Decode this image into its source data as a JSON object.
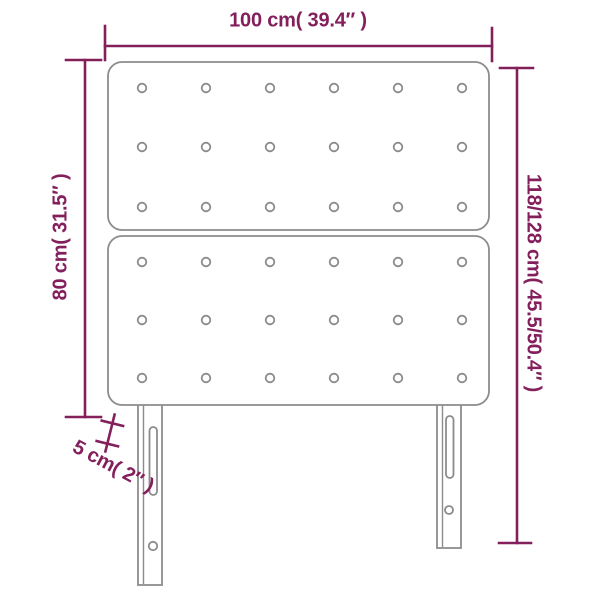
{
  "diagram": {
    "type": "product-dimensions-diagram",
    "product": "tufted-headboard-with-two-panels-and-two-legs",
    "labels": {
      "width": "100 cm( 39.4″ )",
      "panel_height": "80 cm( 31.5″ )",
      "total_height": "118/128 cm( 45.5/50.4″ )",
      "thickness": "5 cm( 2″ )"
    },
    "colors": {
      "dimension_accent": "#83205c",
      "outline_gray": "#8c8c8c",
      "background": "#ffffff"
    },
    "structure": {
      "panel_count": 2,
      "button_columns": 6,
      "button_rows_per_panel": 3,
      "leg_count": 2
    }
  }
}
